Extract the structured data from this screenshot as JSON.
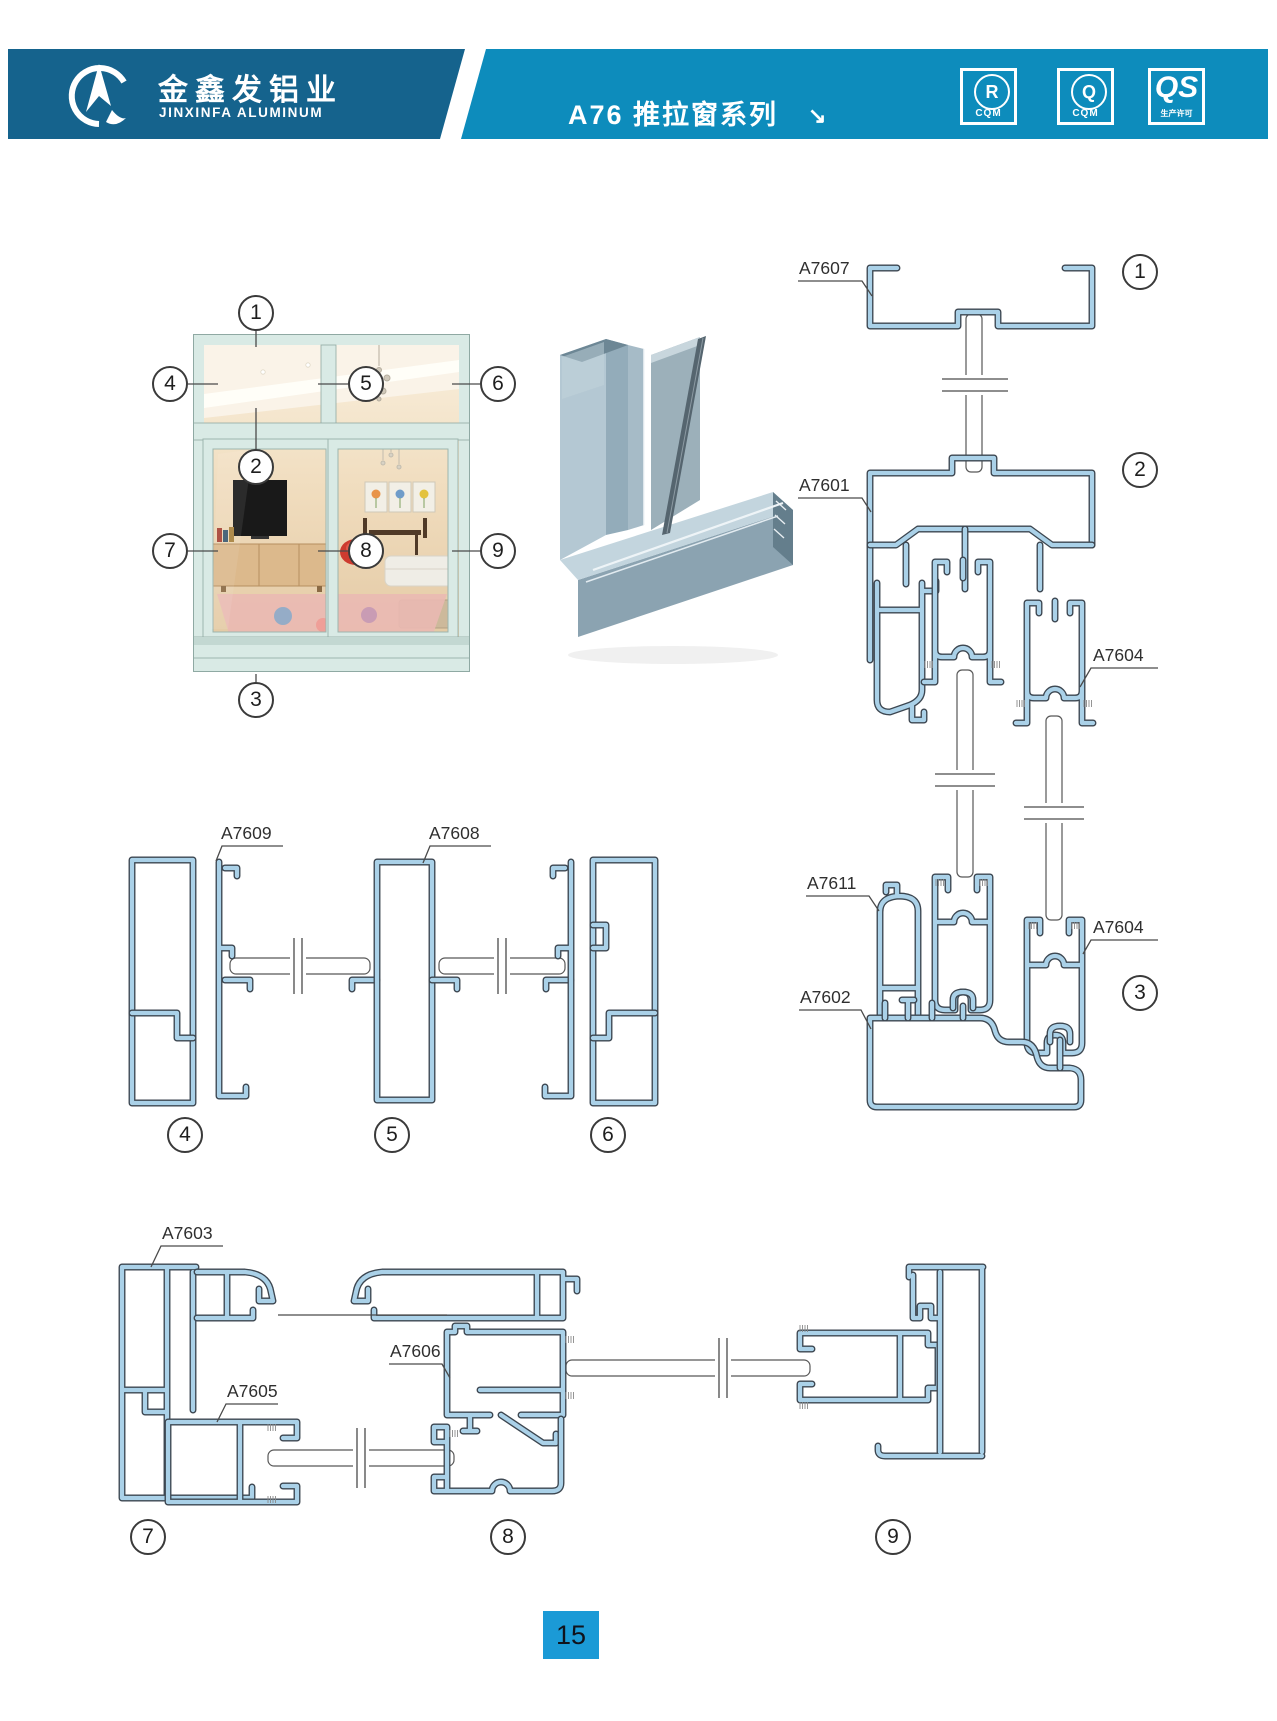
{
  "page": {
    "number": "15",
    "bg": "#ffffff"
  },
  "header": {
    "company_cn": "金鑫发铝业",
    "company_en": "JINXINFA ALUMINUM",
    "series_title": "A76 推拉窗系列",
    "arrow_glyph": "↘",
    "colors": {
      "left_bg": "#15638d",
      "right_bg": "#0d8cbc"
    },
    "certifications": [
      {
        "icon": "cqm-r-badge",
        "letter": "R",
        "sub": "CQM"
      },
      {
        "icon": "cqm-q-badge",
        "letter": "Q",
        "sub": "CQM"
      },
      {
        "icon": "qs-badge",
        "letter": "QS",
        "sub": "生产许可"
      }
    ]
  },
  "window_figure": {
    "callouts": {
      "c1": "1",
      "c2": "2",
      "c3": "3",
      "c4": "4",
      "c5": "5",
      "c6": "6",
      "c7": "7",
      "c8": "8",
      "c9": "9"
    }
  },
  "sections": {
    "vertical_assembly": {
      "labels": {
        "a7607": "A7607",
        "a7601": "A7601",
        "a7604_top": "A7604",
        "a7611": "A7611",
        "a7604_bottom": "A7604",
        "a7602": "A7602"
      },
      "callouts": {
        "c1": "1",
        "c2": "2",
        "c3": "3"
      }
    },
    "horizontal_top": {
      "labels": {
        "a7609": "A7609",
        "a7608": "A7608"
      },
      "callouts": {
        "c4": "4",
        "c5": "5",
        "c6": "6"
      }
    },
    "horizontal_bottom": {
      "labels": {
        "a7603": "A7603",
        "a7605": "A7605",
        "a7606": "A7606"
      },
      "callouts": {
        "c7": "7",
        "c8": "8",
        "c9": "9"
      }
    }
  },
  "drawing": {
    "profile_blue": "#aad1e8",
    "outline": "#3c4650",
    "frame_mint": "#d8e9e4",
    "footer_blue": "#1b9ad6"
  }
}
